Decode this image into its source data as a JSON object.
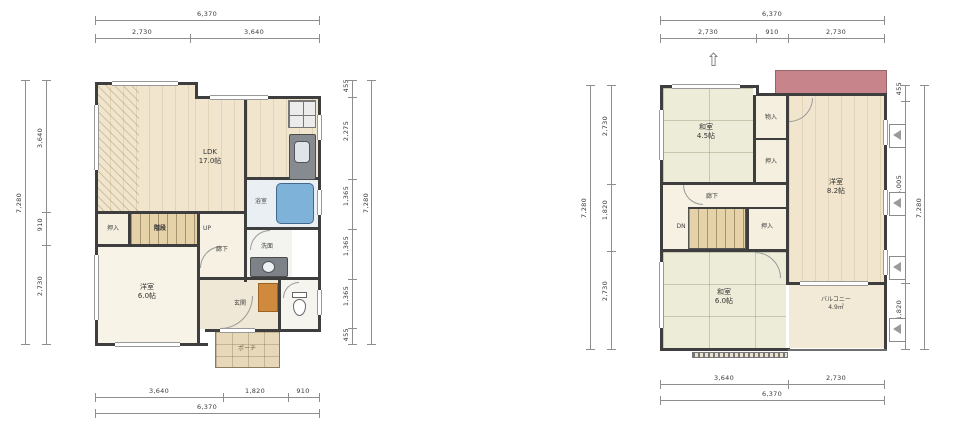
{
  "colors": {
    "wall": "#3e3e3e",
    "bathtub_blue": "#7fb2d8",
    "entrance_mat_orange": "#d08a3e",
    "roof_red": "#c8848b",
    "tatami_green": "#edecd9"
  },
  "floor1": {
    "rooms": {
      "ldk_name": "LDK",
      "ldk_area": "17.0帖",
      "bedroom_name": "洋室",
      "bedroom_area": "6.0帖",
      "closet": "押入",
      "stairs": "階段",
      "up": "UP",
      "hall": "廊下",
      "bath": "浴室",
      "wash": "洗面",
      "entrance": "玄関",
      "porch": "ポーチ"
    },
    "dims": {
      "top_total": "6,370",
      "top_segs": [
        "2,730",
        "3,640"
      ],
      "bottom_segs": [
        "3,640",
        "1,820",
        "910"
      ],
      "bottom_total": "6,370",
      "left_total": "7,280",
      "left_segs": [
        "3,640",
        "910",
        "2,730"
      ],
      "right_segs": [
        "455",
        "2,275",
        "1,365",
        "1,365",
        "1,365",
        "455"
      ],
      "right_total": "7,280"
    }
  },
  "floor2": {
    "rooms": {
      "washitsu1_name": "和室",
      "washitsu1_area": "4.5帖",
      "storage": "物入",
      "closet1": "押入",
      "bedroom_name": "洋室",
      "bedroom_area": "8.2帖",
      "hall": "廊下",
      "dn": "DN",
      "closet2": "押入",
      "washitsu2_name": "和室",
      "washitsu2_area": "6.0帖",
      "balcony_name": "バルコニー",
      "balcony_area": "4.9㎡"
    },
    "dims": {
      "top_total": "6,370",
      "top_segs": [
        "2,730",
        "910",
        "2,730"
      ],
      "bottom_segs": [
        "3,640",
        "2,730"
      ],
      "bottom_total": "6,370",
      "left_total": "7,280",
      "left_segs": [
        "2,730",
        "1,820",
        "2,730"
      ],
      "right_segs": [
        "455",
        "5,005",
        "1,820"
      ],
      "right_total": "7,280"
    }
  }
}
